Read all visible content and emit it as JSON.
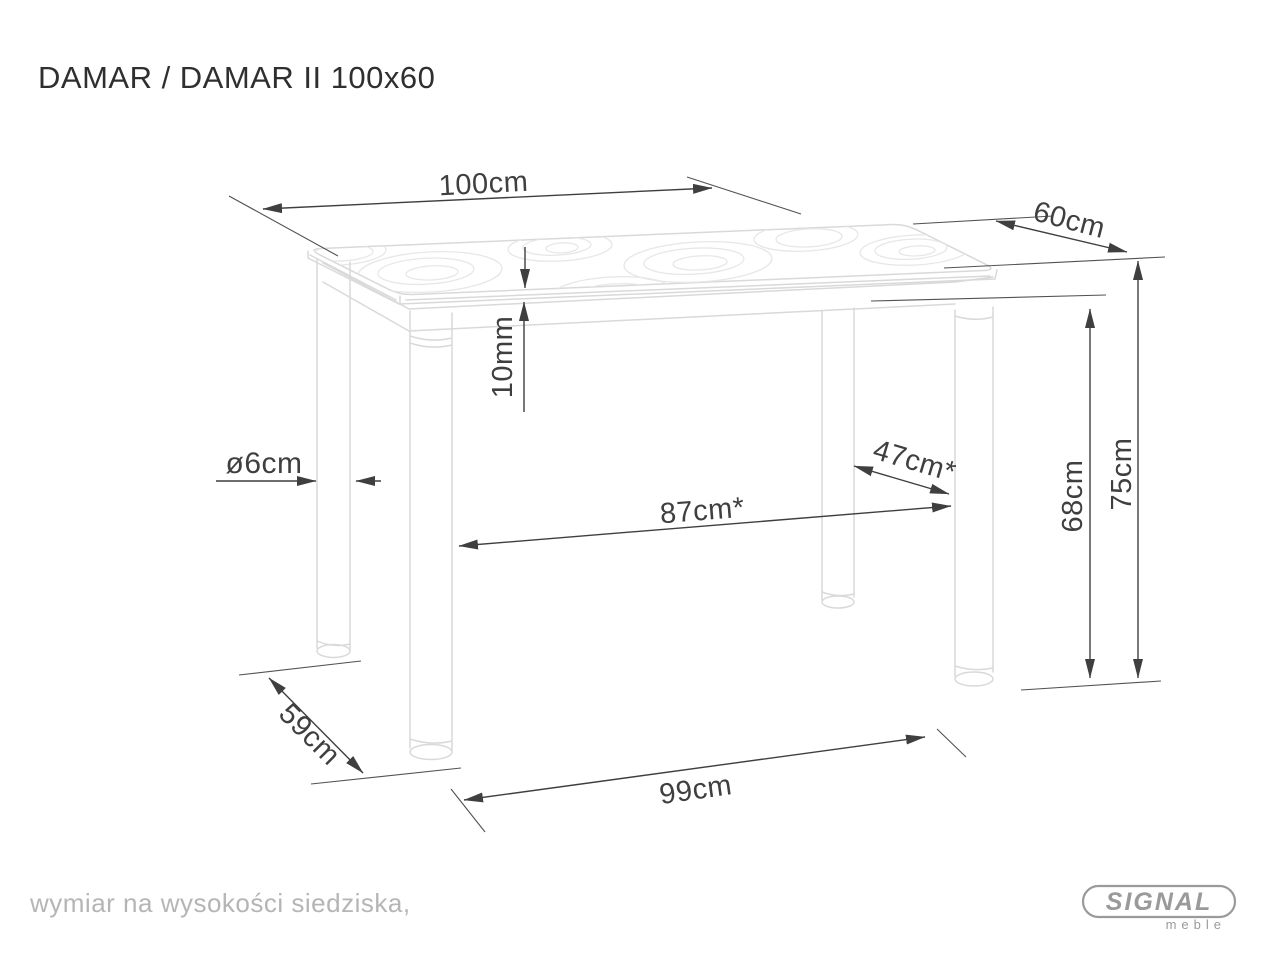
{
  "title": "DAMAR / DAMAR II 100x60",
  "footnote": "wymiar na wysokości siedziska,",
  "logo": {
    "brand": "SIGNAL",
    "sub": "meble"
  },
  "dimensions": {
    "top_width": "100cm",
    "top_depth": "60cm",
    "glass_thickness": "10mm",
    "leg_diameter": "ø6cm",
    "clearance_depth": "47cm*",
    "clearance_width": "87cm*",
    "apron_clearance_height": "68cm",
    "total_height": "75cm",
    "base_width": "99cm",
    "base_depth": "59cm"
  },
  "colors": {
    "dimension_ink": "#3f3f3f",
    "drawing_line": "#d9d9d9",
    "muted_text": "#b5b5b5",
    "logo_gray": "#9a9a9a",
    "title_ink": "#2f2f2f",
    "background": "#ffffff"
  }
}
